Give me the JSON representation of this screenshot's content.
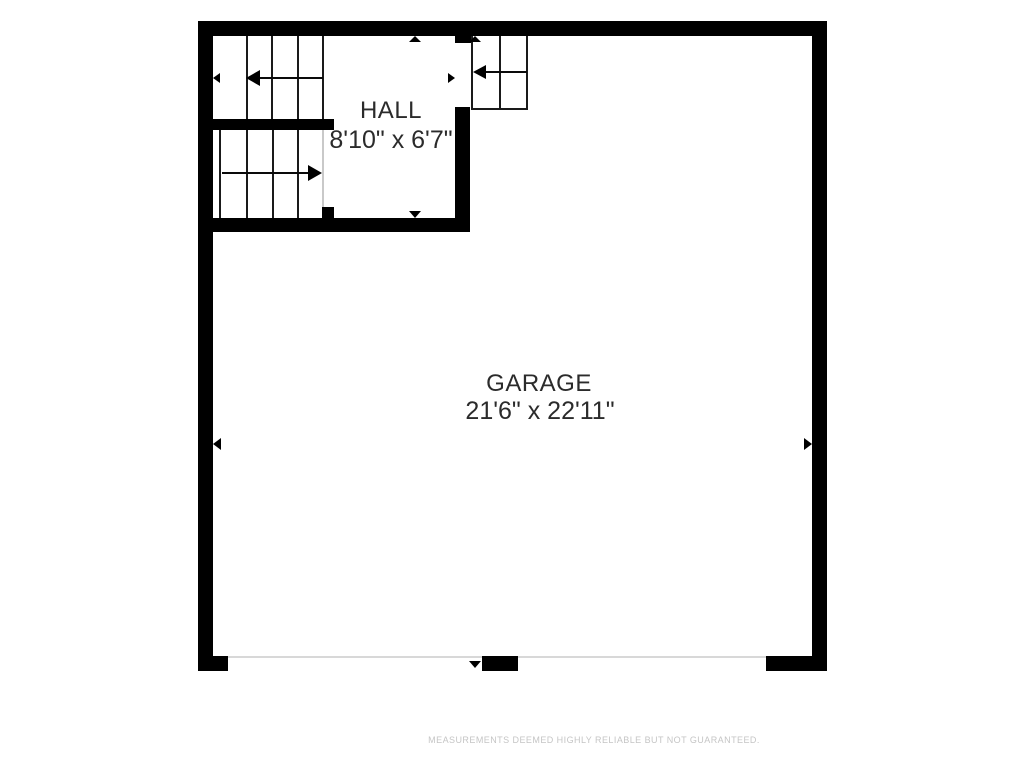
{
  "plan": {
    "rooms": {
      "hall": {
        "name": "HALL",
        "dims": "8'10\" x 6'7\""
      },
      "garage": {
        "name": "GARAGE",
        "dims": "21'6\" x 22'11\""
      }
    },
    "footer": {
      "disclaimer": "MEASUREMENTS DEEMED HIGHLY RELIABLE BUT NOT GUARANTEED."
    },
    "colors": {
      "wall": "#000000",
      "stair_line": "#1a1a1a",
      "garage_door_line": "#d8d8d8",
      "room_label": "#2b2b2b",
      "disclaimer_text": "#c5c5c5",
      "background": "#ffffff"
    },
    "icons": {
      "stair_up_flight_arrow": "left-arrow",
      "stair_down_flight_arrow": "right-arrow",
      "winder_stair_arrow": "left-arrow",
      "dimension_markers": "solid triangles pointing toward measured walls"
    }
  }
}
